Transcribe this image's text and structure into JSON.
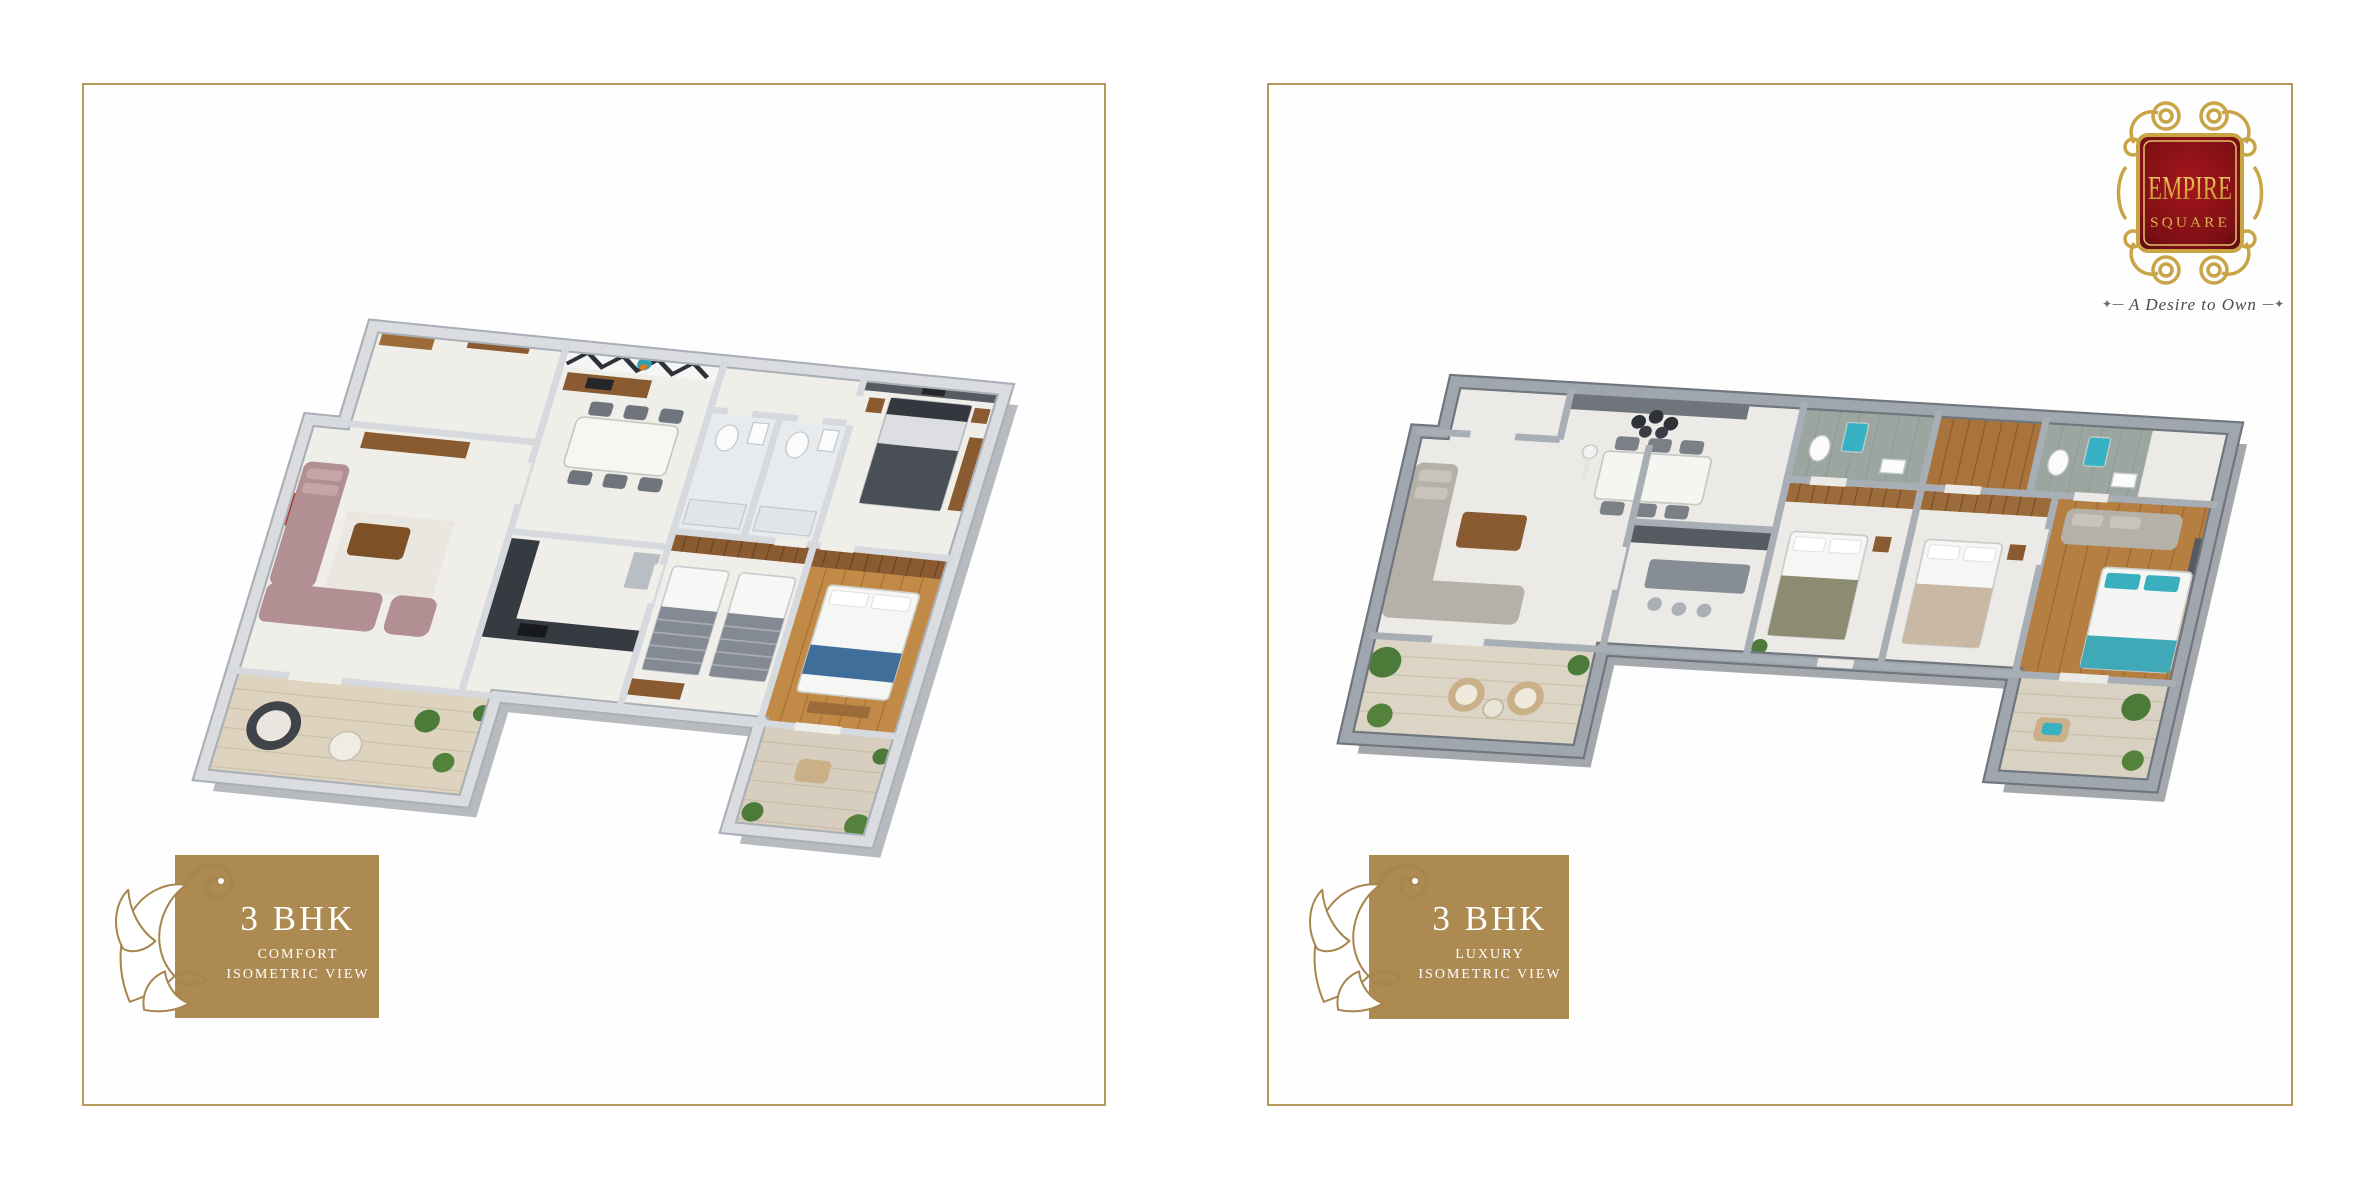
{
  "page": {
    "background": "#ffffff"
  },
  "brand": {
    "line1": "EMPIRE",
    "line2": "SQUARE",
    "tagline": "A Desire to Own",
    "tagline_prefix": "✦—",
    "tagline_suffix": "—✦",
    "badge_red": "#7e1015",
    "badge_gold": "#c9a445"
  },
  "panels": [
    {
      "name": "comfort",
      "title": "3 BHK",
      "subtitle": "COMFORT",
      "view_label": "ISOMETRIC VIEW"
    },
    {
      "name": "luxury",
      "title": "3 BHK",
      "subtitle": "LUXURY",
      "view_label": "ISOMETRIC VIEW"
    }
  ],
  "colors": {
    "panel_border": "#b49a5c",
    "label_box": "#ad8a52",
    "label_text": "#ffffff",
    "flourish_stroke": "#a9854e",
    "left_plan_wall": "#dadce0",
    "right_plan_wall": "#9fa6ad",
    "wood_floor": "#c28a47",
    "balcony_floor": "#ddd3bf",
    "teal_accent": "#3aafbf",
    "sofa_mauve": "#b28f93",
    "sofa_gray": "#b5b1a8",
    "kitchen_dark": "#363a41",
    "wood_furniture": "#8a5a30",
    "plant_green": "#4c7a38"
  }
}
